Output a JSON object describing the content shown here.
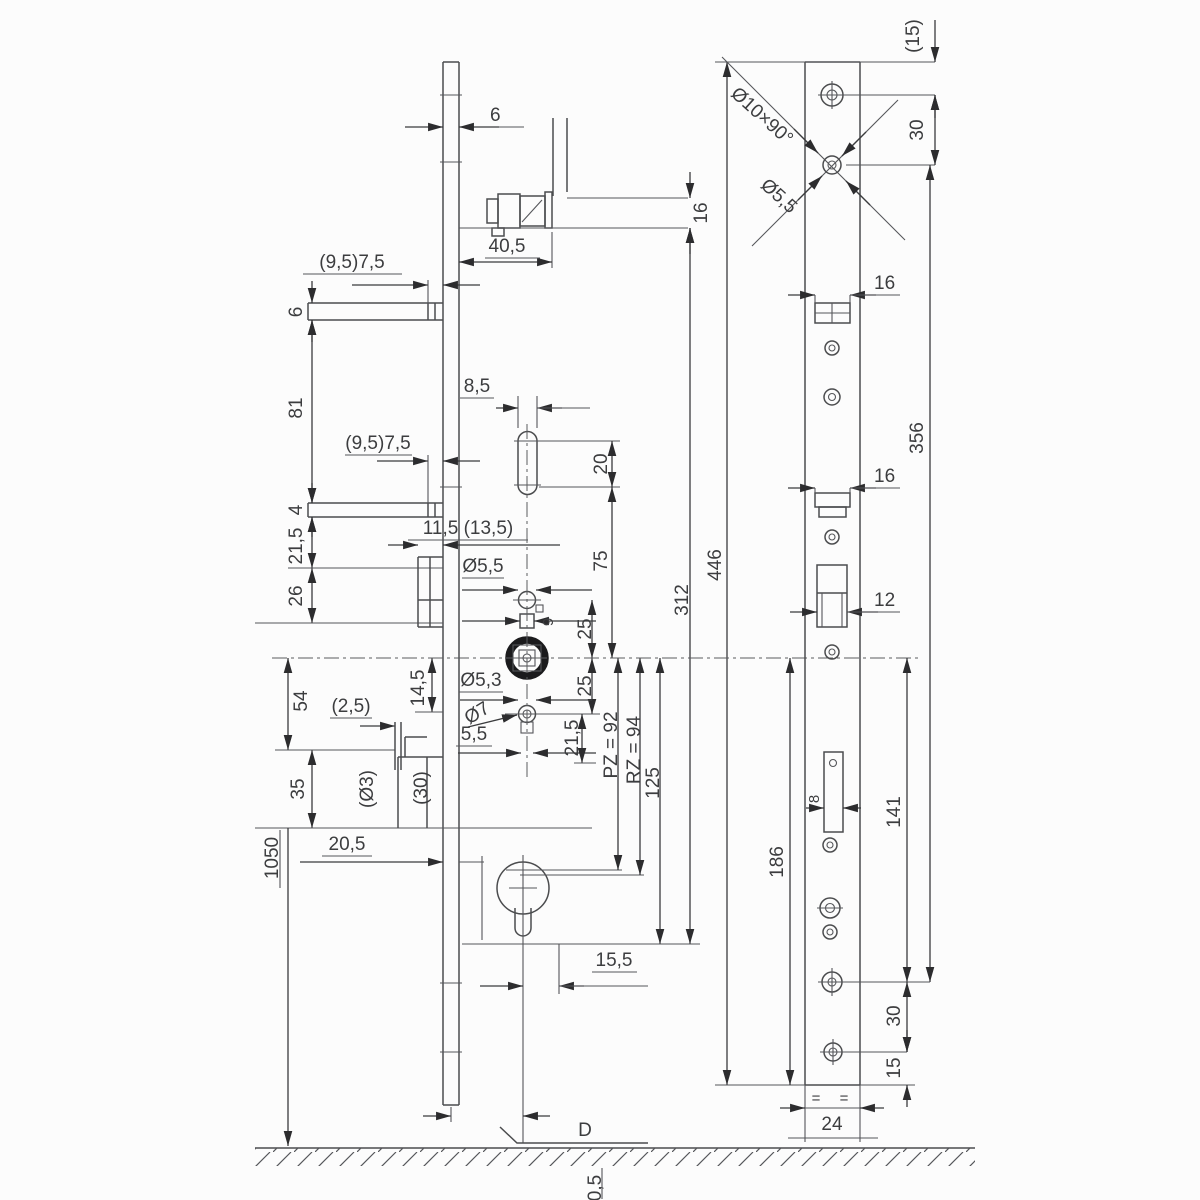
{
  "drawing": {
    "type": "technical-dimension-drawing",
    "subject": "Multi-point door lock: side section view and faceplate front view with installation dimensions (mm)",
    "colors": {
      "background": "#fcfcfc",
      "line": "#4b4c4e",
      "text": "#3c3d3f",
      "arrow": "#2c2c2e"
    },
    "side_view": {
      "strip_width": "6",
      "cable_offset": "40,5",
      "cable_height": "16",
      "keep1_offset": "(9,5)7,5",
      "keep1_height": "6",
      "keep_gap": "81",
      "keep2_offset": "(9,5)7,5",
      "slot_width": "8,5",
      "slot_height": "20",
      "plate_thickness": "4",
      "dim_21_5_upper": "21,5",
      "dim_26": "26",
      "keep_depth": "11,5 (13,5)",
      "hole_upper_dia": "Ø5,5",
      "dim_75": "75",
      "spindle_square": "9",
      "dim_25_upper": "25",
      "dim_25_lower": "25",
      "hole_lower_dia": "Ø5,3",
      "hole_lower_dia2": "Ø7",
      "dim_5_5": "5,5",
      "dim_21_5_lower": "21,5",
      "dim_14_5": "14,5",
      "dim_54": "54",
      "dim_35": "35",
      "dim_2_5": "(2,5)",
      "dim_d3": "(Ø3)",
      "dim_30": "(30)",
      "dim_20_5": "20,5",
      "handle_height": "1050",
      "pz": "PZ = 92",
      "rz": "RZ = 94",
      "dim_125": "125",
      "dim_312": "312",
      "dim_446": "446",
      "dim_15_5": "15,5",
      "datum": "D",
      "floor_clearance": "0,5"
    },
    "front_view": {
      "top_margin": "(15)",
      "hole_pitch_top": "30",
      "countersink": "Ø10×90°",
      "hole_dia": "Ø5,5",
      "slot1_width": "16",
      "slot2_width": "16",
      "length_356": "356",
      "latch_width": "12",
      "dim_141": "141",
      "dim_186": "186",
      "slot_8": "8",
      "hole_pitch_bottom": "30",
      "bottom_margin": "15",
      "plate_width": "24",
      "equal_left": "=",
      "equal_right": "="
    }
  }
}
